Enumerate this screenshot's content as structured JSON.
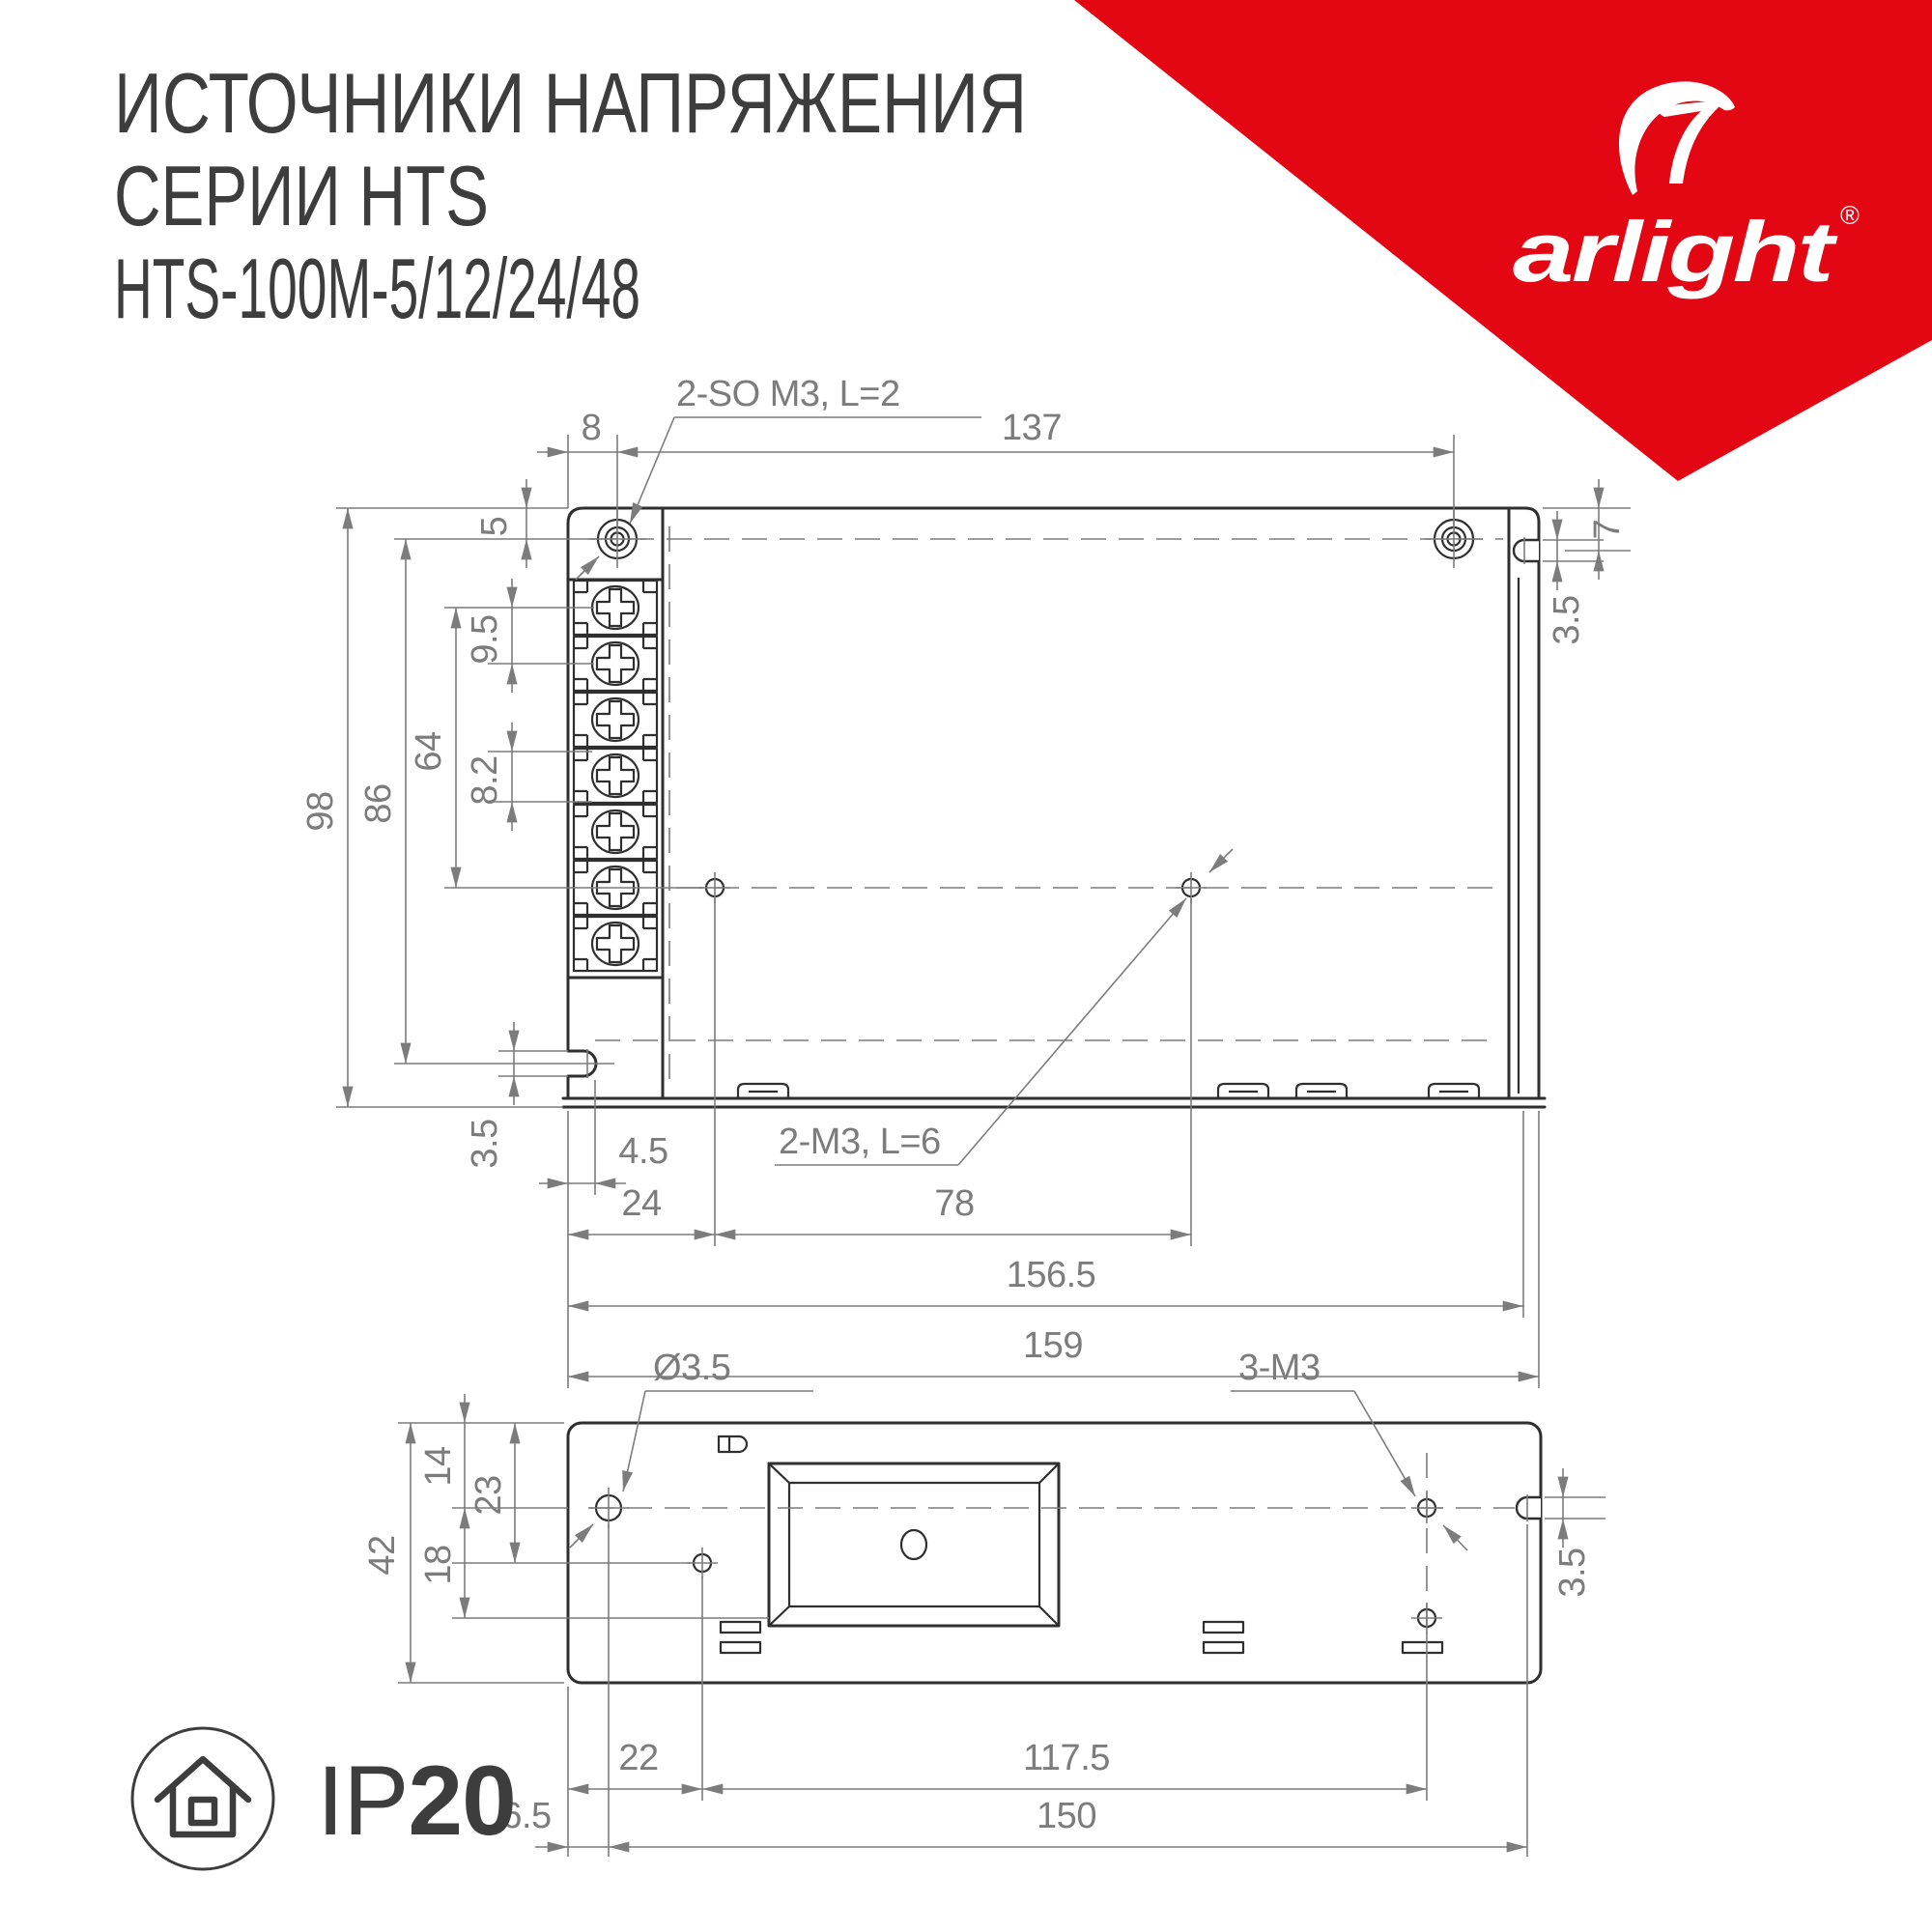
{
  "header": {
    "title_line1": "ИСТОЧНИКИ НАПРЯЖЕНИЯ",
    "title_line2": "СЕРИИ HTS",
    "title_line3": "HTS-100M-5/12/24/48"
  },
  "brand": {
    "wordmark": "arlight",
    "registered_mark": "®",
    "triangle_color": "#e30613"
  },
  "ip_badge": {
    "prefix": "IP",
    "value": "20"
  },
  "top_view": {
    "label_screws_top": "2-SO M3, L=2",
    "label_screws_bottom": "2-M3, L=6",
    "dim_8": "8",
    "dim_137": "137",
    "dim_5": "5",
    "dim_9_5": "9.5",
    "dim_64": "64",
    "dim_8_2": "8.2",
    "dim_98": "98",
    "dim_86": "86",
    "dim_3_5": "3.5",
    "dim_7": "7",
    "dim_4_5": "4.5",
    "dim_24": "24",
    "dim_78": "78",
    "dim_156_5": "156.5",
    "dim_159": "159"
  },
  "bottom_view": {
    "label_hole_diameter": "Ø3.5",
    "label_screws": "3-M3",
    "dim_14": "14",
    "dim_23": "23",
    "dim_42": "42",
    "dim_18": "18",
    "dim_3_5": "3.5",
    "dim_22": "22",
    "dim_117_5": "117.5",
    "dim_6_5": "6.5",
    "dim_150": "150"
  }
}
